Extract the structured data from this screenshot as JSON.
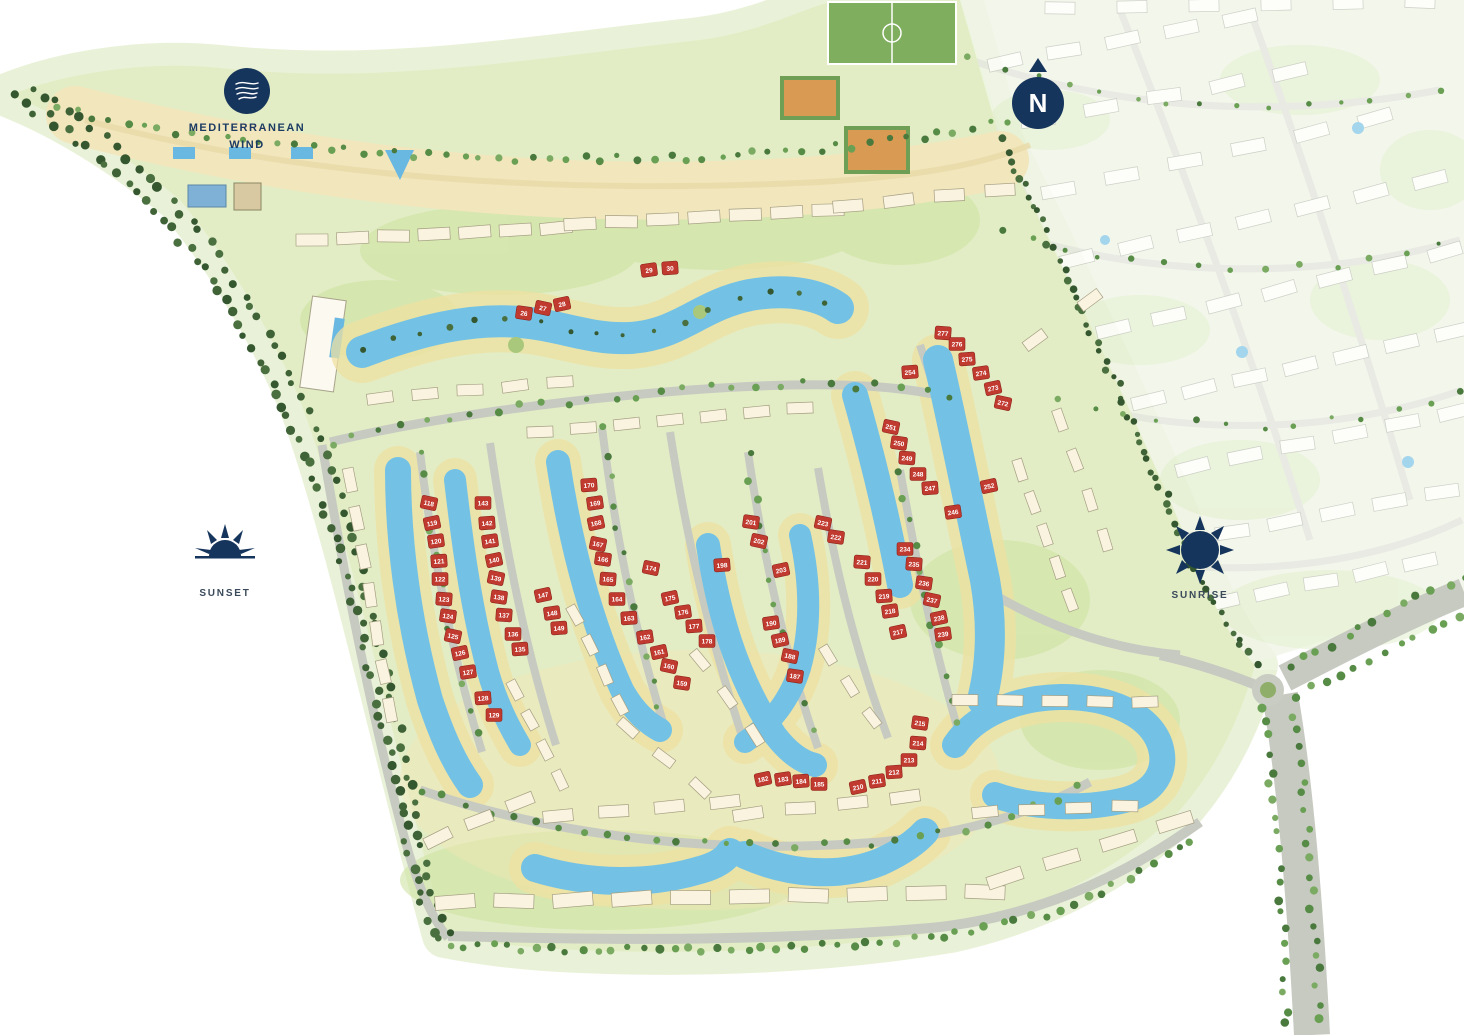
{
  "map": {
    "labels": {
      "district_logo": {
        "line1": "MEDITERRANEAN",
        "line2": "WIND"
      },
      "sunset": "SUNSET",
      "sunrise": "SUNRISE",
      "compass_n": "N"
    },
    "icons": {
      "logo": "wave-logo-icon",
      "compass": "north-compass-icon",
      "sunset": "half-sun-icon",
      "sunrise": "full-sun-icon"
    },
    "colors": {
      "navy": "#16355c",
      "lake_blue": "#73c2e5",
      "sand": "#efe1a2",
      "road_gray": "#c7cac1",
      "plot_red": "#c13a30",
      "green_light": "#e2edc5",
      "green_dark": "#44683a"
    },
    "plots": [
      {
        "n": 26,
        "x": 524,
        "y": 313
      },
      {
        "n": 27,
        "x": 543,
        "y": 308
      },
      {
        "n": 28,
        "x": 562,
        "y": 304
      },
      {
        "n": 29,
        "x": 649,
        "y": 270
      },
      {
        "n": 30,
        "x": 670,
        "y": 268
      },
      {
        "n": 118,
        "x": 429,
        "y": 503
      },
      {
        "n": 119,
        "x": 432,
        "y": 523
      },
      {
        "n": 120,
        "x": 436,
        "y": 541
      },
      {
        "n": 121,
        "x": 439,
        "y": 561
      },
      {
        "n": 122,
        "x": 440,
        "y": 579
      },
      {
        "n": 123,
        "x": 444,
        "y": 599
      },
      {
        "n": 124,
        "x": 448,
        "y": 616
      },
      {
        "n": 125,
        "x": 453,
        "y": 636
      },
      {
        "n": 126,
        "x": 460,
        "y": 653
      },
      {
        "n": 127,
        "x": 468,
        "y": 672
      },
      {
        "n": 128,
        "x": 483,
        "y": 698
      },
      {
        "n": 129,
        "x": 494,
        "y": 715
      },
      {
        "n": 143,
        "x": 483,
        "y": 503
      },
      {
        "n": 142,
        "x": 487,
        "y": 523
      },
      {
        "n": 141,
        "x": 490,
        "y": 541
      },
      {
        "n": 140,
        "x": 494,
        "y": 560
      },
      {
        "n": 139,
        "x": 496,
        "y": 578
      },
      {
        "n": 138,
        "x": 499,
        "y": 597
      },
      {
        "n": 137,
        "x": 504,
        "y": 615
      },
      {
        "n": 136,
        "x": 513,
        "y": 634
      },
      {
        "n": 135,
        "x": 520,
        "y": 649
      },
      {
        "n": 147,
        "x": 543,
        "y": 595
      },
      {
        "n": 148,
        "x": 552,
        "y": 613
      },
      {
        "n": 149,
        "x": 559,
        "y": 628
      },
      {
        "n": 170,
        "x": 589,
        "y": 485
      },
      {
        "n": 169,
        "x": 595,
        "y": 503
      },
      {
        "n": 168,
        "x": 596,
        "y": 523
      },
      {
        "n": 167,
        "x": 598,
        "y": 544
      },
      {
        "n": 166,
        "x": 603,
        "y": 559
      },
      {
        "n": 165,
        "x": 608,
        "y": 579
      },
      {
        "n": 164,
        "x": 617,
        "y": 599
      },
      {
        "n": 163,
        "x": 629,
        "y": 618
      },
      {
        "n": 162,
        "x": 645,
        "y": 637
      },
      {
        "n": 161,
        "x": 659,
        "y": 652
      },
      {
        "n": 160,
        "x": 669,
        "y": 666
      },
      {
        "n": 159,
        "x": 682,
        "y": 683
      },
      {
        "n": 174,
        "x": 651,
        "y": 568
      },
      {
        "n": 175,
        "x": 670,
        "y": 598
      },
      {
        "n": 176,
        "x": 683,
        "y": 612
      },
      {
        "n": 177,
        "x": 694,
        "y": 626
      },
      {
        "n": 178,
        "x": 707,
        "y": 641
      },
      {
        "n": 198,
        "x": 722,
        "y": 565
      },
      {
        "n": 201,
        "x": 751,
        "y": 522
      },
      {
        "n": 202,
        "x": 759,
        "y": 541
      },
      {
        "n": 203,
        "x": 781,
        "y": 570
      },
      {
        "n": 190,
        "x": 771,
        "y": 623
      },
      {
        "n": 189,
        "x": 780,
        "y": 640
      },
      {
        "n": 188,
        "x": 790,
        "y": 656
      },
      {
        "n": 187,
        "x": 795,
        "y": 676
      },
      {
        "n": 182,
        "x": 763,
        "y": 779
      },
      {
        "n": 183,
        "x": 783,
        "y": 779
      },
      {
        "n": 184,
        "x": 801,
        "y": 781
      },
      {
        "n": 185,
        "x": 819,
        "y": 784
      },
      {
        "n": 210,
        "x": 858,
        "y": 787
      },
      {
        "n": 211,
        "x": 877,
        "y": 781
      },
      {
        "n": 212,
        "x": 894,
        "y": 772
      },
      {
        "n": 213,
        "x": 909,
        "y": 760
      },
      {
        "n": 214,
        "x": 918,
        "y": 743
      },
      {
        "n": 215,
        "x": 920,
        "y": 723
      },
      {
        "n": 223,
        "x": 823,
        "y": 523
      },
      {
        "n": 222,
        "x": 836,
        "y": 537
      },
      {
        "n": 221,
        "x": 862,
        "y": 562
      },
      {
        "n": 220,
        "x": 873,
        "y": 579
      },
      {
        "n": 219,
        "x": 884,
        "y": 596
      },
      {
        "n": 218,
        "x": 890,
        "y": 611
      },
      {
        "n": 217,
        "x": 898,
        "y": 632
      },
      {
        "n": 234,
        "x": 905,
        "y": 549
      },
      {
        "n": 235,
        "x": 914,
        "y": 564
      },
      {
        "n": 236,
        "x": 924,
        "y": 583
      },
      {
        "n": 237,
        "x": 932,
        "y": 600
      },
      {
        "n": 238,
        "x": 939,
        "y": 618
      },
      {
        "n": 239,
        "x": 943,
        "y": 634
      },
      {
        "n": 254,
        "x": 910,
        "y": 372
      },
      {
        "n": 251,
        "x": 891,
        "y": 427
      },
      {
        "n": 250,
        "x": 899,
        "y": 443
      },
      {
        "n": 249,
        "x": 907,
        "y": 458
      },
      {
        "n": 248,
        "x": 918,
        "y": 474
      },
      {
        "n": 247,
        "x": 930,
        "y": 488
      },
      {
        "n": 246,
        "x": 953,
        "y": 512
      },
      {
        "n": 252,
        "x": 989,
        "y": 486
      },
      {
        "n": 277,
        "x": 943,
        "y": 333
      },
      {
        "n": 276,
        "x": 957,
        "y": 344
      },
      {
        "n": 275,
        "x": 967,
        "y": 359
      },
      {
        "n": 274,
        "x": 981,
        "y": 373
      },
      {
        "n": 273,
        "x": 993,
        "y": 388
      },
      {
        "n": 272,
        "x": 1003,
        "y": 403
      }
    ]
  }
}
